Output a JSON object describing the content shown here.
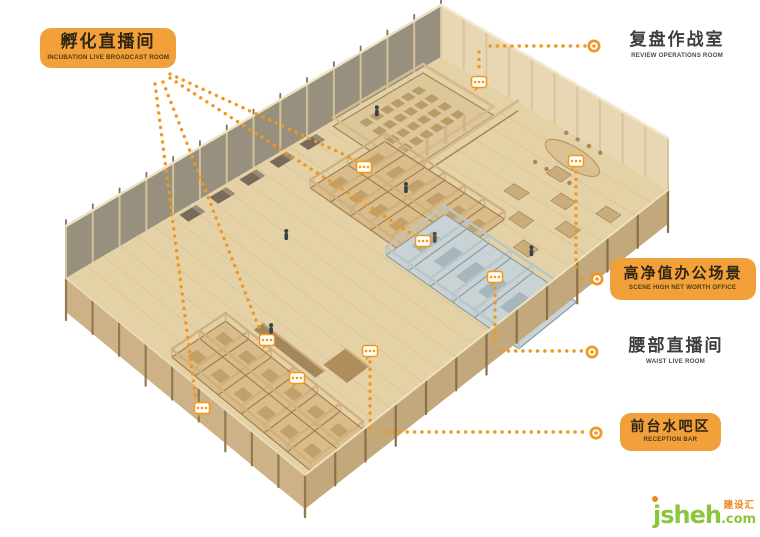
{
  "canvas": {
    "width": 760,
    "height": 537,
    "background": "#FFFFFF"
  },
  "annotations": {
    "incubation_live_room": {
      "label_cn": "孵化直播间",
      "label_en": "INCUBATION LIVE BROADCAST ROOM",
      "style": "orange-box"
    },
    "review_operations_room": {
      "label_cn": "复盘作战室",
      "label_en": "REVIEW OPERATIONS ROOM",
      "style": "plain-text"
    },
    "high_net_worth_office": {
      "label_cn": "高净值办公场景",
      "label_en": "SCENE HIGH NET WORTH OFFICE",
      "style": "orange-box"
    },
    "waist_live_room": {
      "label_cn": "腰部直播间",
      "label_en": "WAIST LIVE ROOM",
      "style": "plain-text"
    },
    "reception_bar": {
      "label_cn": "前台水吧区",
      "label_en": "RECEPTION BAR",
      "style": "orange-box"
    }
  },
  "markers": {
    "bubble_icon": "ellipsis-speech-bubble-icon",
    "endpoint_icon": "donut-circle-icon",
    "leader_style": "orange-dotted",
    "bubble_count": 9
  },
  "watermark": {
    "name": "jsheh",
    "tld": ".com",
    "cn": "建设汇"
  },
  "colors": {
    "accent_orange": "#F2A13A",
    "leader_orange": "#F0981E",
    "label_text": "#2F2512",
    "plain_label_text": "#3D3D3D",
    "floor_tan": "#E4D1A6",
    "room_floor_tan": "#D9BC8A",
    "wall_tan": "#CFB17E",
    "wall_seam": "#9C7C4E",
    "blue_room_floor": "#C9D2D4",
    "blue_room_wall": "#B9C6C9",
    "glass_wall": "#97907F",
    "facade_tan": "#C2A87A",
    "watermark_green": "#8CC63E",
    "watermark_orange": "#F08519"
  }
}
